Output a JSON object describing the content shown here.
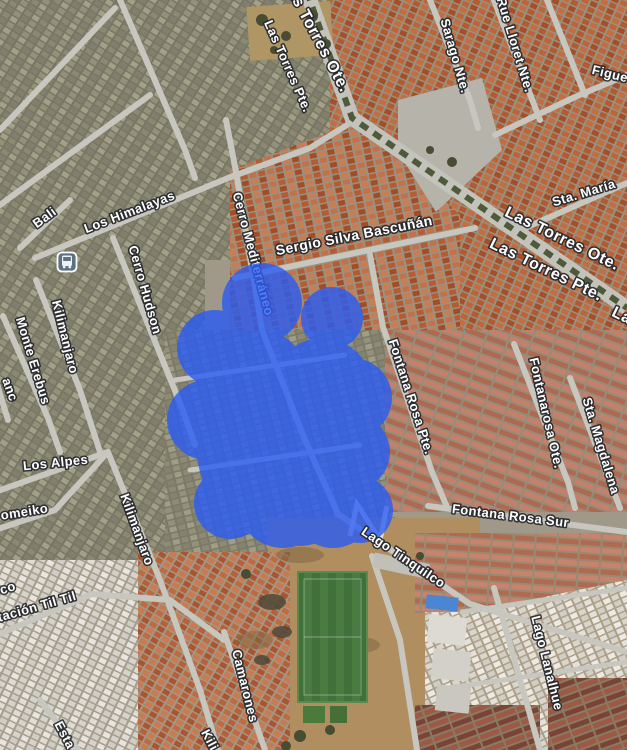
{
  "map": {
    "overlay": {
      "color": "#2a5cf4",
      "shape": "freehand-blue-region"
    },
    "transit_stop": {
      "icon": "bus-icon"
    },
    "streets": {
      "las_torres_ote_top": "Las Torres Ote.",
      "las_torres_pte_top": "Las Torres Pte.",
      "sarago_nte": "Sarago Nte.",
      "rue_lloret_nte": "Rue Lloret Nte.",
      "figue_partial": "Figue",
      "sta_maria": "Sta. María",
      "las_torres_ote_mid": "Las Torres Ote.",
      "las_torres_pte_mid": "Las Torres Pte.",
      "las_partial": "Las",
      "fontanarosa_ote": "Fontanarosa Ote.",
      "sta_magdalena": "Sta. Magdalena",
      "fontana_rosa_pte": "Fontana Rosa Pte.",
      "fontana_rosa_sur": "Fontana Rosa Sur",
      "sergio_silva": "Sergio Silva Bascuñán",
      "cerro_mediterraneo": "Cerro Mediterráneo",
      "los_himalayas": "Los Himalayas",
      "bali": "Bali",
      "cerro_hudson": "Cerro Hudson",
      "kilimanjaro_1": "Kilimanjaro",
      "monte_erebus": "Monte Erebus",
      "blanc_partial": "anc",
      "los_alpes": "Los Alpes",
      "omeiko_partial": "omeiko",
      "kilimanjaro_2": "Kilimanjaro",
      "estacion_til_til": "Estación Til Til",
      "co_partial": "co",
      "camarones": "Camarones",
      "lago_tinquilco": "Lago Tinquilco",
      "lago_lanalhue": "Lago Lanalhue",
      "kili_partial": "Kili",
      "esta_partial": "Esta"
    }
  }
}
